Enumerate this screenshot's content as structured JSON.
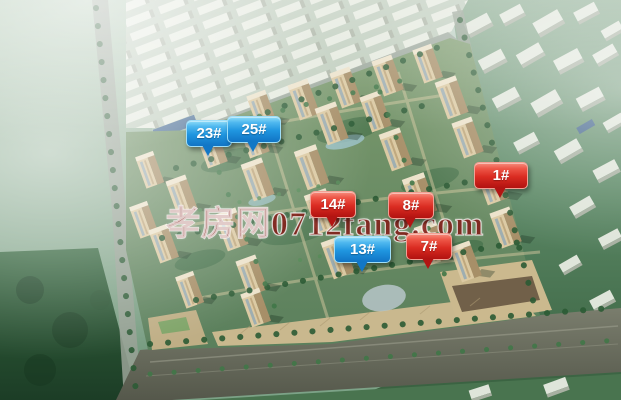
{
  "watermark": {
    "text": "孝房网0712fang.com",
    "color": "#7d0f0a"
  },
  "pins": [
    {
      "label": "23#",
      "variant": "blue"
    },
    {
      "label": "25#",
      "variant": "blue"
    },
    {
      "label": "14#",
      "variant": "red"
    },
    {
      "label": "8#",
      "variant": "red"
    },
    {
      "label": "1#",
      "variant": "red"
    },
    {
      "label": "13#",
      "variant": "blue"
    },
    {
      "label": "7#",
      "variant": "red"
    }
  ],
  "colors": {
    "pin_blue_top": "#90ddf9",
    "pin_blue_bottom": "#1173c4",
    "pin_red_top": "#f68e7e",
    "pin_red_bottom": "#b21210",
    "watermark_red": "#7d0f0a"
  }
}
